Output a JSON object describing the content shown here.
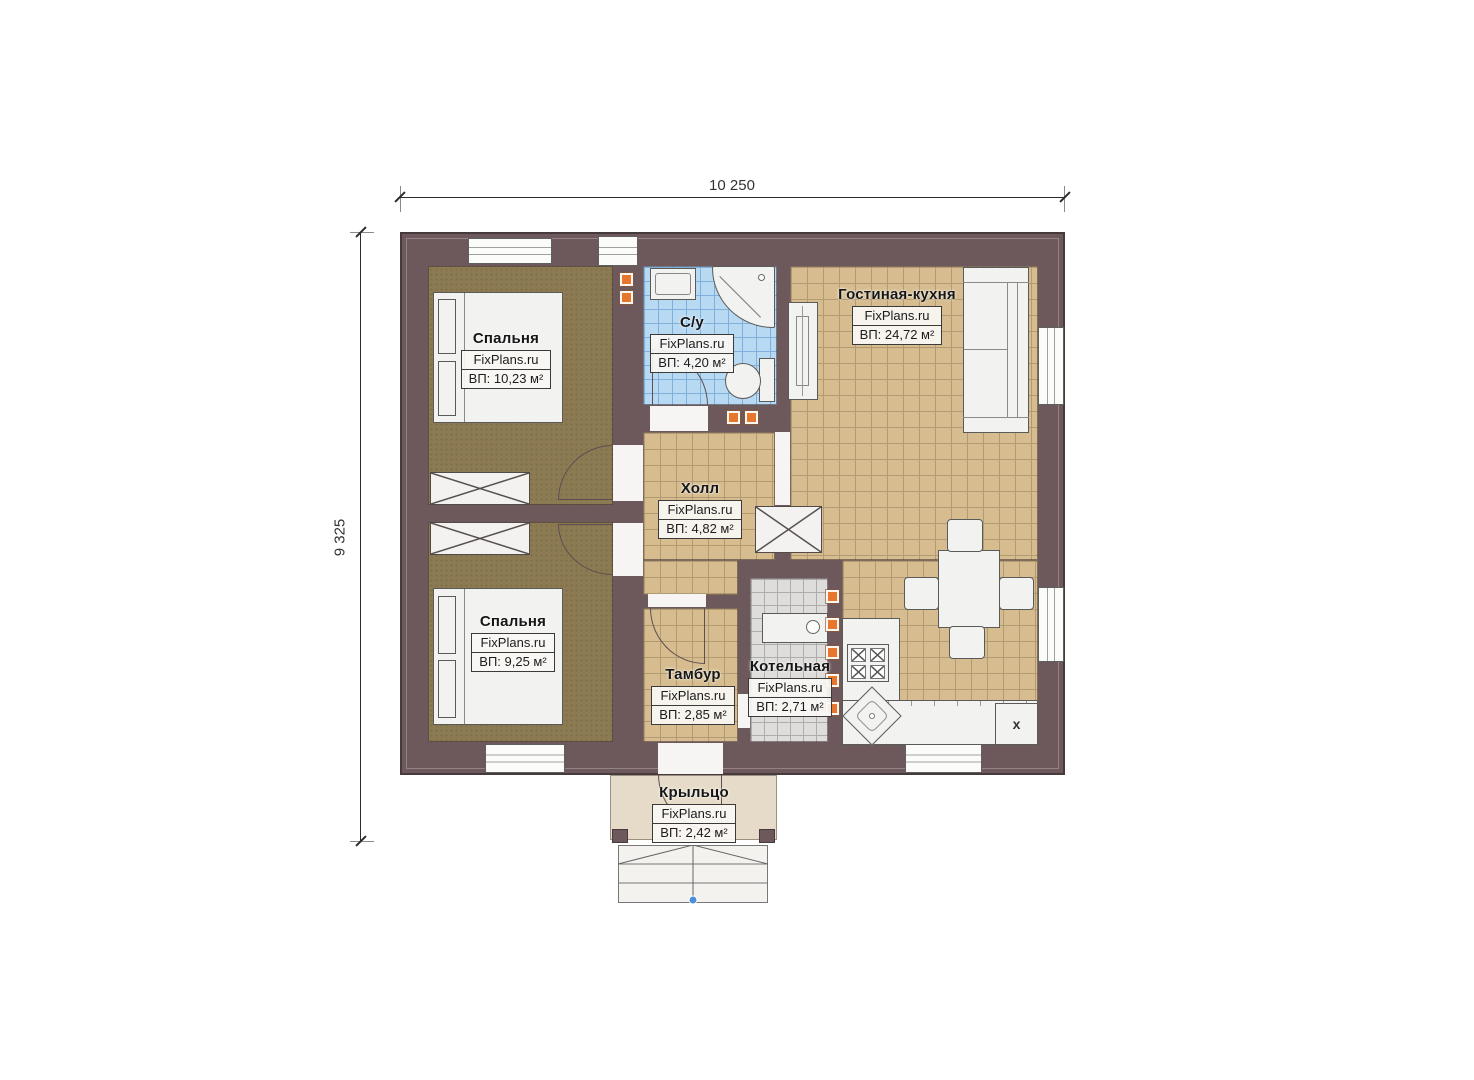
{
  "dimensions": {
    "width_label": "10 250",
    "height_label": "9 325"
  },
  "watermark": "FixPlans.ru",
  "rooms": [
    {
      "id": "bedroom-1",
      "name": "Спальня",
      "area": "ВП: 10,23 м²"
    },
    {
      "id": "bathroom",
      "name": "С/у",
      "area": "ВП: 4,20 м²"
    },
    {
      "id": "living-kitchen",
      "name": "Гостиная-кухня",
      "area": "ВП: 24,72 м²"
    },
    {
      "id": "hall",
      "name": "Холл",
      "area": "ВП: 4,82 м²"
    },
    {
      "id": "bedroom-2",
      "name": "Спальня",
      "area": "ВП: 9,25 м²"
    },
    {
      "id": "vestibule",
      "name": "Тамбур",
      "area": "ВП: 2,85 м²"
    },
    {
      "id": "boiler-room",
      "name": "Котельная",
      "area": "ВП: 2,71 м²"
    },
    {
      "id": "porch",
      "name": "Крыльцо",
      "area": "ВП: 2,42 м²"
    }
  ],
  "appliances": {
    "marked_unit_label": "x"
  },
  "colors": {
    "wall": "#6d585c",
    "floor_tile_tan": "#d6bc8f",
    "floor_tile_blue": "#b8d9f2",
    "floor_tile_gray": "#dedddb",
    "floor_carpet": "#8b7a52",
    "porch_floor": "#e6dbc8",
    "vent_orange": "#e8772e",
    "porch_dot_blue": "#4a90d9"
  }
}
